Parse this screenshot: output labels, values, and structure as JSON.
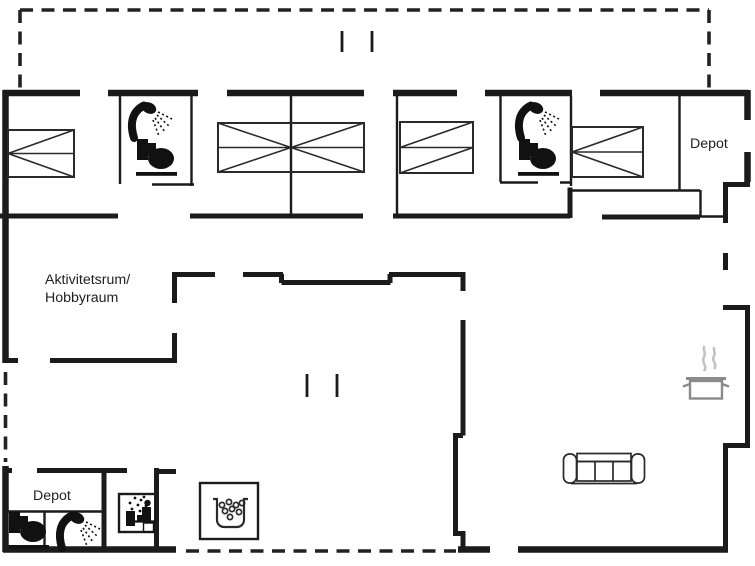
{
  "page": {
    "type": "floor-plan",
    "background": "#ffffff"
  },
  "labels": {
    "activity_room_line1": "Aktivitetsrum/",
    "activity_room_line2": "Hobbyraum",
    "depot_top_right": "Depot",
    "depot_bottom_left": "Depot"
  },
  "icons": {
    "shower": "shower-icon",
    "toilet": "toilet-icon",
    "sauna": "sauna-icon",
    "whirlpool": "whirlpool-icon",
    "sofa": "sofa-icon",
    "cooking_pot": "cooking-pot-icon",
    "beds": [
      "bed-top-left",
      "bed-double-center",
      "bed-top-middle-right",
      "bed-top-right"
    ],
    "opening_ticks": "door-opening-ticks"
  },
  "colors": {
    "wall": "#1b1b1b",
    "furniture_line": "#2a2a2a",
    "pot": "#8a8a8a",
    "steam": "#c3c3c3",
    "background": "#ffffff"
  }
}
